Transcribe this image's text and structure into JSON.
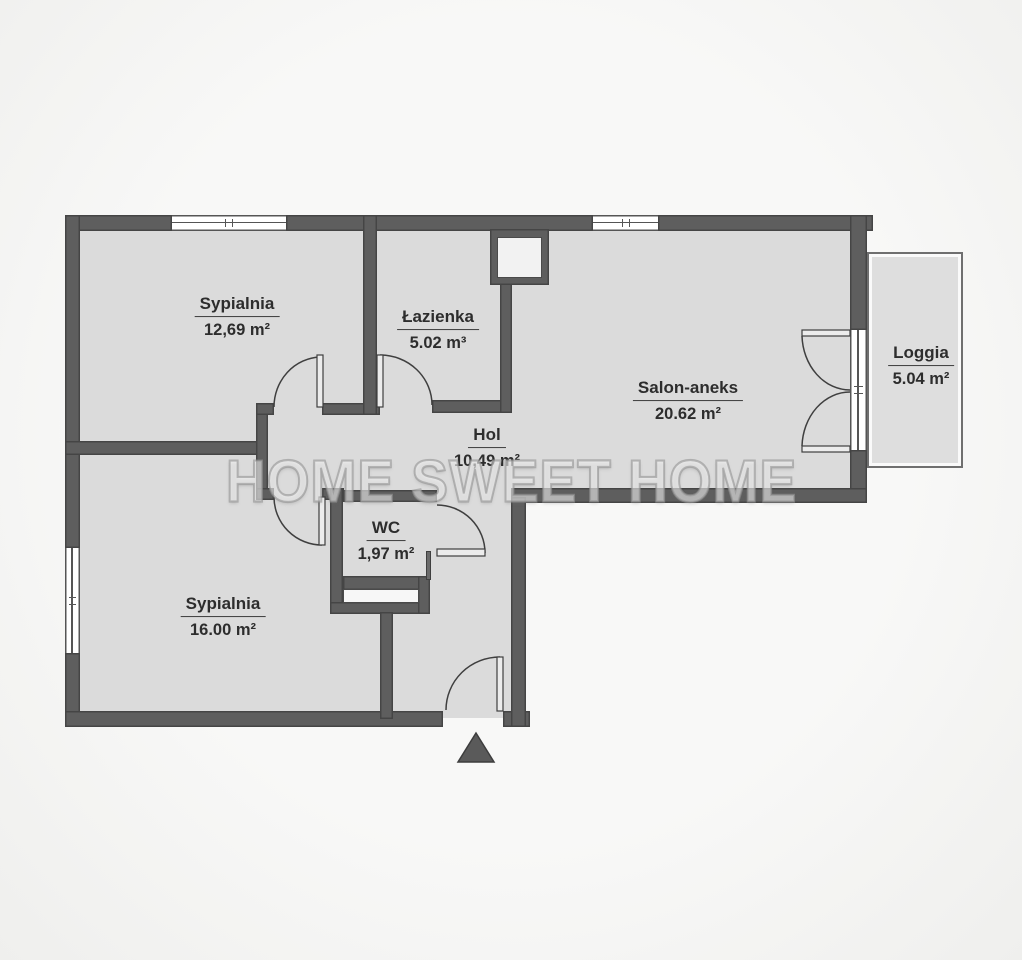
{
  "watermark": "HOME SWEET HOME",
  "rooms": [
    {
      "id": "bedroom-1",
      "name": "Sypialnia",
      "area": "12,69 m²"
    },
    {
      "id": "bathroom",
      "name": "Łazienka",
      "area": "5.02 m³"
    },
    {
      "id": "hall",
      "name": "Hol",
      "area": "10,49 m²"
    },
    {
      "id": "salon",
      "name": "Salon-aneks",
      "area": "20.62 m²"
    },
    {
      "id": "wc",
      "name": "WC",
      "area": "1,97 m²"
    },
    {
      "id": "bedroom-2",
      "name": "Sypialnia",
      "area": "16.00 m²"
    },
    {
      "id": "loggia",
      "name": "Loggia",
      "area": "5.04 m²"
    }
  ],
  "icons": {
    "entrance_marker": "triangle-up-icon"
  },
  "colors": {
    "wall": "#5e5e5e",
    "wall_outline": "#454545",
    "room_fill": "#dbdbdb",
    "background": "#f6f6f5",
    "label_text": "#2d2d2d",
    "watermark": "#c9c9c9"
  }
}
